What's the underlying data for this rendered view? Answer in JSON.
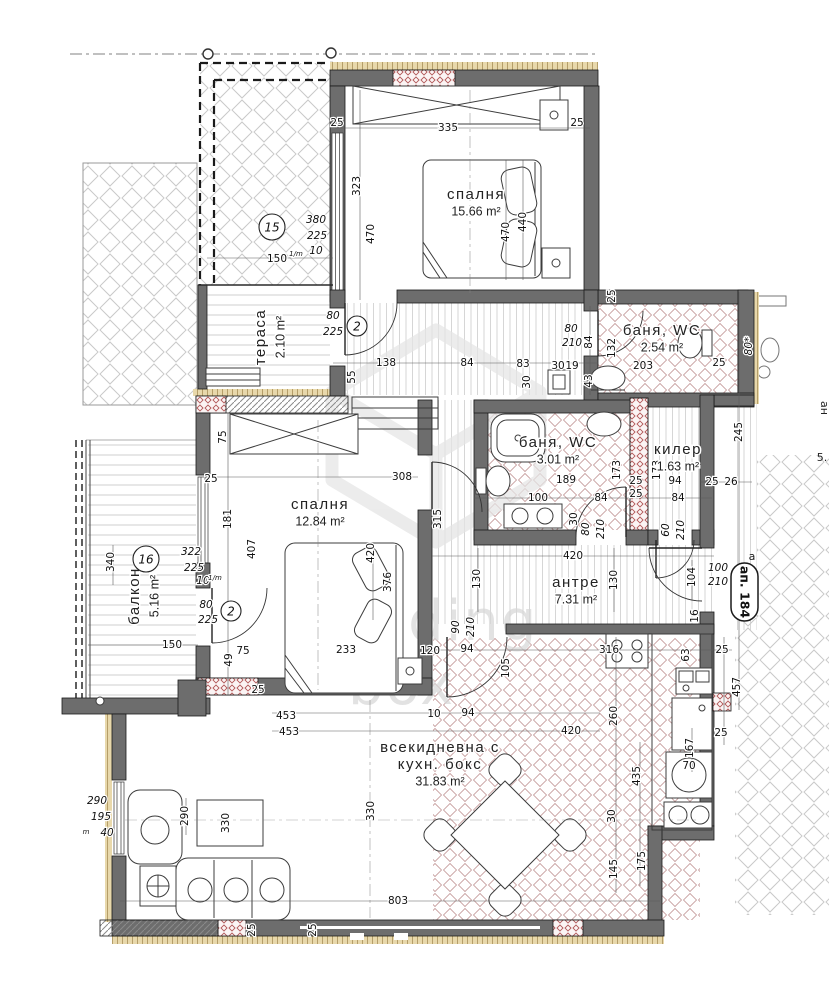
{
  "plan": {
    "watermark": [
      "building",
      "box"
    ],
    "apartment_badge": "ап. 184",
    "axis_letter": "а",
    "neighbor_labels": [
      "ан",
      "5."
    ]
  },
  "rooms": [
    {
      "lines": [
        "спалня",
        "15.66 m²"
      ],
      "x": 476,
      "y": 195,
      "r": 0
    },
    {
      "lines": [
        "спалня",
        "12.84 m²"
      ],
      "x": 320,
      "y": 505,
      "r": 0
    },
    {
      "lines": [
        "баня, WC",
        "2.54 m²"
      ],
      "x": 662,
      "y": 331,
      "r": 0
    },
    {
      "lines": [
        "баня, WC",
        "3.01 m²"
      ],
      "x": 558,
      "y": 443,
      "r": 0
    },
    {
      "lines": [
        "килер",
        "1.63 m²"
      ],
      "x": 678,
      "y": 450,
      "r": 0
    },
    {
      "lines": [
        "антре",
        "7.31 m²"
      ],
      "x": 576,
      "y": 583,
      "r": 0
    },
    {
      "lines": [
        "тераса",
        "2.10 m²"
      ],
      "x": 261,
      "y": 337,
      "r": -90
    },
    {
      "lines": [
        "балкон",
        "5.16 m²"
      ],
      "x": 135,
      "y": 596,
      "r": -90
    },
    {
      "lines": [
        "всекидневна с",
        "кухн. бокс",
        "31.83 m²"
      ],
      "x": 440,
      "y": 748,
      "r": 0
    }
  ],
  "dims": [
    {
      "t": "335",
      "x": 448,
      "y": 128
    },
    {
      "t": "25",
      "x": 337,
      "y": 123
    },
    {
      "t": "25",
      "x": 577,
      "y": 123
    },
    {
      "t": "323",
      "x": 357,
      "y": 186,
      "r": -90
    },
    {
      "t": "470",
      "x": 371,
      "y": 234,
      "r": -90
    },
    {
      "t": "470",
      "x": 506,
      "y": 232,
      "r": -90
    },
    {
      "t": "440",
      "x": 523,
      "y": 222,
      "r": -90
    },
    {
      "t": "380",
      "x": 316,
      "y": 220,
      "i": 1
    },
    {
      "t": "225",
      "x": 317,
      "y": 236,
      "i": 1
    },
    {
      "t": "10",
      "x": 316,
      "y": 251,
      "i": 1
    },
    {
      "t": "150",
      "x": 277,
      "y": 259
    },
    {
      "t": "1/m",
      "x": 296,
      "y": 254,
      "s": 1,
      "i": 1
    },
    {
      "t": "80",
      "x": 333,
      "y": 316,
      "i": 1
    },
    {
      "t": "225",
      "x": 333,
      "y": 332,
      "i": 1
    },
    {
      "t": "138",
      "x": 386,
      "y": 363
    },
    {
      "t": "84",
      "x": 467,
      "y": 363
    },
    {
      "t": "83",
      "x": 523,
      "y": 364
    },
    {
      "t": "55",
      "x": 352,
      "y": 377,
      "r": -90
    },
    {
      "t": "30",
      "x": 527,
      "y": 382,
      "r": -90
    },
    {
      "t": "30",
      "x": 558,
      "y": 366
    },
    {
      "t": "19",
      "x": 572,
      "y": 366
    },
    {
      "t": "80",
      "x": 571,
      "y": 329,
      "i": 1
    },
    {
      "t": "210",
      "x": 572,
      "y": 343,
      "i": 1
    },
    {
      "t": "84",
      "x": 589,
      "y": 342,
      "r": -90
    },
    {
      "t": "132",
      "x": 612,
      "y": 348,
      "r": -90
    },
    {
      "t": "43",
      "x": 589,
      "y": 381,
      "r": -90
    },
    {
      "t": "25",
      "x": 612,
      "y": 296,
      "r": -90
    },
    {
      "t": "203",
      "x": 643,
      "y": 366
    },
    {
      "t": "25",
      "x": 719,
      "y": 363
    },
    {
      "t": "80*",
      "x": 749,
      "y": 346,
      "r": -90,
      "i": 1
    },
    {
      "t": "245",
      "x": 739,
      "y": 432,
      "r": -90
    },
    {
      "t": "25",
      "x": 712,
      "y": 482
    },
    {
      "t": "26",
      "x": 731,
      "y": 482
    },
    {
      "t": "189",
      "x": 566,
      "y": 480
    },
    {
      "t": "100",
      "x": 538,
      "y": 498
    },
    {
      "t": "84",
      "x": 601,
      "y": 498
    },
    {
      "t": "173",
      "x": 617,
      "y": 470,
      "r": -90
    },
    {
      "t": "25",
      "x": 636,
      "y": 481
    },
    {
      "t": "25",
      "x": 636,
      "y": 494
    },
    {
      "t": "173",
      "x": 657,
      "y": 470,
      "r": -90
    },
    {
      "t": "94",
      "x": 675,
      "y": 481
    },
    {
      "t": "84",
      "x": 678,
      "y": 498
    },
    {
      "t": "30",
      "x": 574,
      "y": 519,
      "r": -90
    },
    {
      "t": "80",
      "x": 586,
      "y": 529,
      "r": -90,
      "i": 1
    },
    {
      "t": "210",
      "x": 601,
      "y": 529,
      "r": -90,
      "i": 1
    },
    {
      "t": "60",
      "x": 666,
      "y": 530,
      "r": -90,
      "i": 1
    },
    {
      "t": "210",
      "x": 681,
      "y": 530,
      "r": -90,
      "i": 1
    },
    {
      "t": "75",
      "x": 223,
      "y": 437,
      "r": -90
    },
    {
      "t": "25",
      "x": 211,
      "y": 479
    },
    {
      "t": "181",
      "x": 228,
      "y": 519,
      "r": -90
    },
    {
      "t": "407",
      "x": 252,
      "y": 549,
      "r": -90
    },
    {
      "t": "308",
      "x": 402,
      "y": 477
    },
    {
      "t": "315",
      "x": 438,
      "y": 519,
      "r": -90
    },
    {
      "t": "322",
      "x": 191,
      "y": 552,
      "i": 1
    },
    {
      "t": "225",
      "x": 194,
      "y": 568,
      "i": 1
    },
    {
      "t": "10",
      "x": 203,
      "y": 581,
      "i": 1
    },
    {
      "t": "1/m",
      "x": 215,
      "y": 578,
      "s": 1,
      "i": 1
    },
    {
      "t": "80",
      "x": 206,
      "y": 605,
      "i": 1
    },
    {
      "t": "225",
      "x": 208,
      "y": 620,
      "i": 1
    },
    {
      "t": "340",
      "x": 111,
      "y": 562,
      "r": -90
    },
    {
      "t": "150",
      "x": 172,
      "y": 645
    },
    {
      "t": "420",
      "x": 371,
      "y": 553,
      "r": -90
    },
    {
      "t": "376",
      "x": 388,
      "y": 582,
      "r": -90
    },
    {
      "t": "233",
      "x": 346,
      "y": 650
    },
    {
      "t": "120",
      "x": 430,
      "y": 651
    },
    {
      "t": "75",
      "x": 243,
      "y": 651
    },
    {
      "t": "49",
      "x": 229,
      "y": 660,
      "r": -90
    },
    {
      "t": "25",
      "x": 258,
      "y": 690
    },
    {
      "t": "420",
      "x": 573,
      "y": 556
    },
    {
      "t": "130",
      "x": 477,
      "y": 579,
      "r": -90
    },
    {
      "t": "130",
      "x": 614,
      "y": 580,
      "r": -90
    },
    {
      "t": "104",
      "x": 692,
      "y": 577,
      "r": -90
    },
    {
      "t": "100",
      "x": 718,
      "y": 568,
      "i": 1
    },
    {
      "t": "210",
      "x": 718,
      "y": 582,
      "i": 1
    },
    {
      "t": "90",
      "x": 456,
      "y": 627,
      "r": -90,
      "i": 1
    },
    {
      "t": "210",
      "x": 471,
      "y": 627,
      "r": -90,
      "i": 1
    },
    {
      "t": "94",
      "x": 467,
      "y": 649
    },
    {
      "t": "105",
      "x": 506,
      "y": 668,
      "r": -90
    },
    {
      "t": "16",
      "x": 695,
      "y": 616,
      "r": -90
    },
    {
      "t": "63",
      "x": 686,
      "y": 655,
      "r": -90
    },
    {
      "t": "316",
      "x": 609,
      "y": 650
    },
    {
      "t": "25",
      "x": 722,
      "y": 650
    },
    {
      "t": "457",
      "x": 737,
      "y": 687,
      "r": -90
    },
    {
      "t": "10",
      "x": 434,
      "y": 714
    },
    {
      "t": "94",
      "x": 468,
      "y": 713
    },
    {
      "t": "420",
      "x": 571,
      "y": 731
    },
    {
      "t": "453",
      "x": 286,
      "y": 716
    },
    {
      "t": "453",
      "x": 289,
      "y": 732
    },
    {
      "t": "330",
      "x": 371,
      "y": 811,
      "r": -90
    },
    {
      "t": "330",
      "x": 226,
      "y": 823,
      "r": -90
    },
    {
      "t": "290",
      "x": 185,
      "y": 816,
      "r": -90
    },
    {
      "t": "290",
      "x": 97,
      "y": 801,
      "i": 1
    },
    {
      "t": "195",
      "x": 101,
      "y": 817,
      "i": 1
    },
    {
      "t": "40",
      "x": 107,
      "y": 833,
      "i": 1
    },
    {
      "t": "m",
      "x": 86,
      "y": 832,
      "s": 1,
      "i": 1
    },
    {
      "t": "803",
      "x": 398,
      "y": 901
    },
    {
      "t": "145",
      "x": 614,
      "y": 869,
      "r": -90
    },
    {
      "t": "175",
      "x": 642,
      "y": 861,
      "r": -90
    },
    {
      "t": "30",
      "x": 612,
      "y": 816,
      "r": -90
    },
    {
      "t": "435",
      "x": 637,
      "y": 776,
      "r": -90
    },
    {
      "t": "260",
      "x": 614,
      "y": 716,
      "r": -90
    },
    {
      "t": "167",
      "x": 690,
      "y": 748,
      "r": -90
    },
    {
      "t": "70",
      "x": 689,
      "y": 766
    },
    {
      "t": "25",
      "x": 721,
      "y": 733
    },
    {
      "t": "25",
      "x": 252,
      "y": 930,
      "r": -90
    },
    {
      "t": "25",
      "x": 313,
      "y": 930,
      "r": -90
    }
  ],
  "tags": [
    {
      "t": "15",
      "x": 272,
      "y": 227,
      "rad": 13
    },
    {
      "t": "16",
      "x": 146,
      "y": 559,
      "rad": 13
    },
    {
      "t": "2",
      "x": 357,
      "y": 326,
      "rad": 10
    },
    {
      "t": "2",
      "x": 231,
      "y": 611,
      "rad": 10
    }
  ]
}
